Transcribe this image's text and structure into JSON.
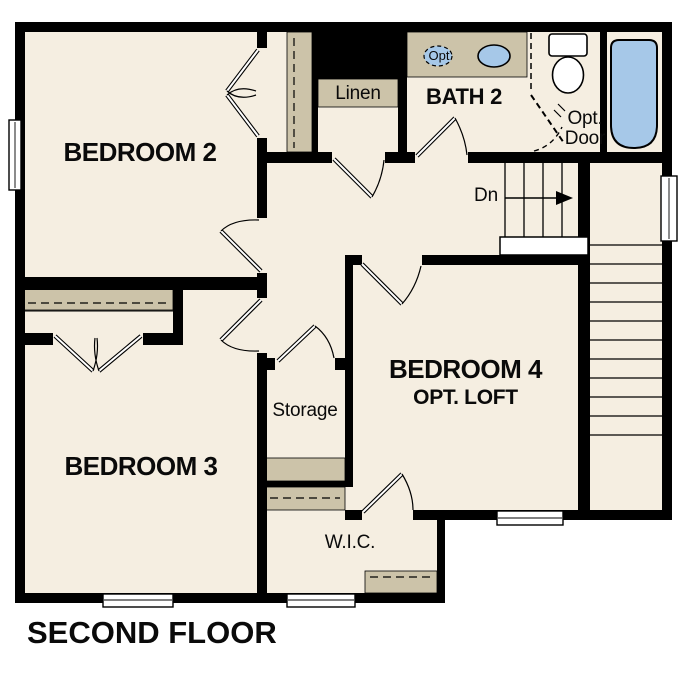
{
  "plan": {
    "title": "SECOND FLOOR",
    "rooms": [
      {
        "name": "bedroom-2",
        "label": "BEDROOM 2"
      },
      {
        "name": "bedroom-3",
        "label": "BEDROOM 3"
      },
      {
        "name": "bedroom-4",
        "label": "BEDROOM 4",
        "sublabel": "OPT. LOFT"
      },
      {
        "name": "bath-2",
        "label": "BATH 2"
      },
      {
        "name": "linen-closet",
        "label": "Linen"
      },
      {
        "name": "storage",
        "label": "Storage"
      },
      {
        "name": "walk-in-closet",
        "label": "W.I.C."
      }
    ],
    "annotations": [
      {
        "name": "stairs-down",
        "label": "Dn"
      },
      {
        "name": "optional-door",
        "label": "Opt. Door"
      },
      {
        "name": "optional-sink",
        "label": "Opt"
      }
    ],
    "colors": {
      "floor": "#f5eee1",
      "wall": "#000000",
      "casework_tan": "#ccc3a9",
      "fixture_blue": "#a6c8e8",
      "background": "#ffffff"
    }
  }
}
